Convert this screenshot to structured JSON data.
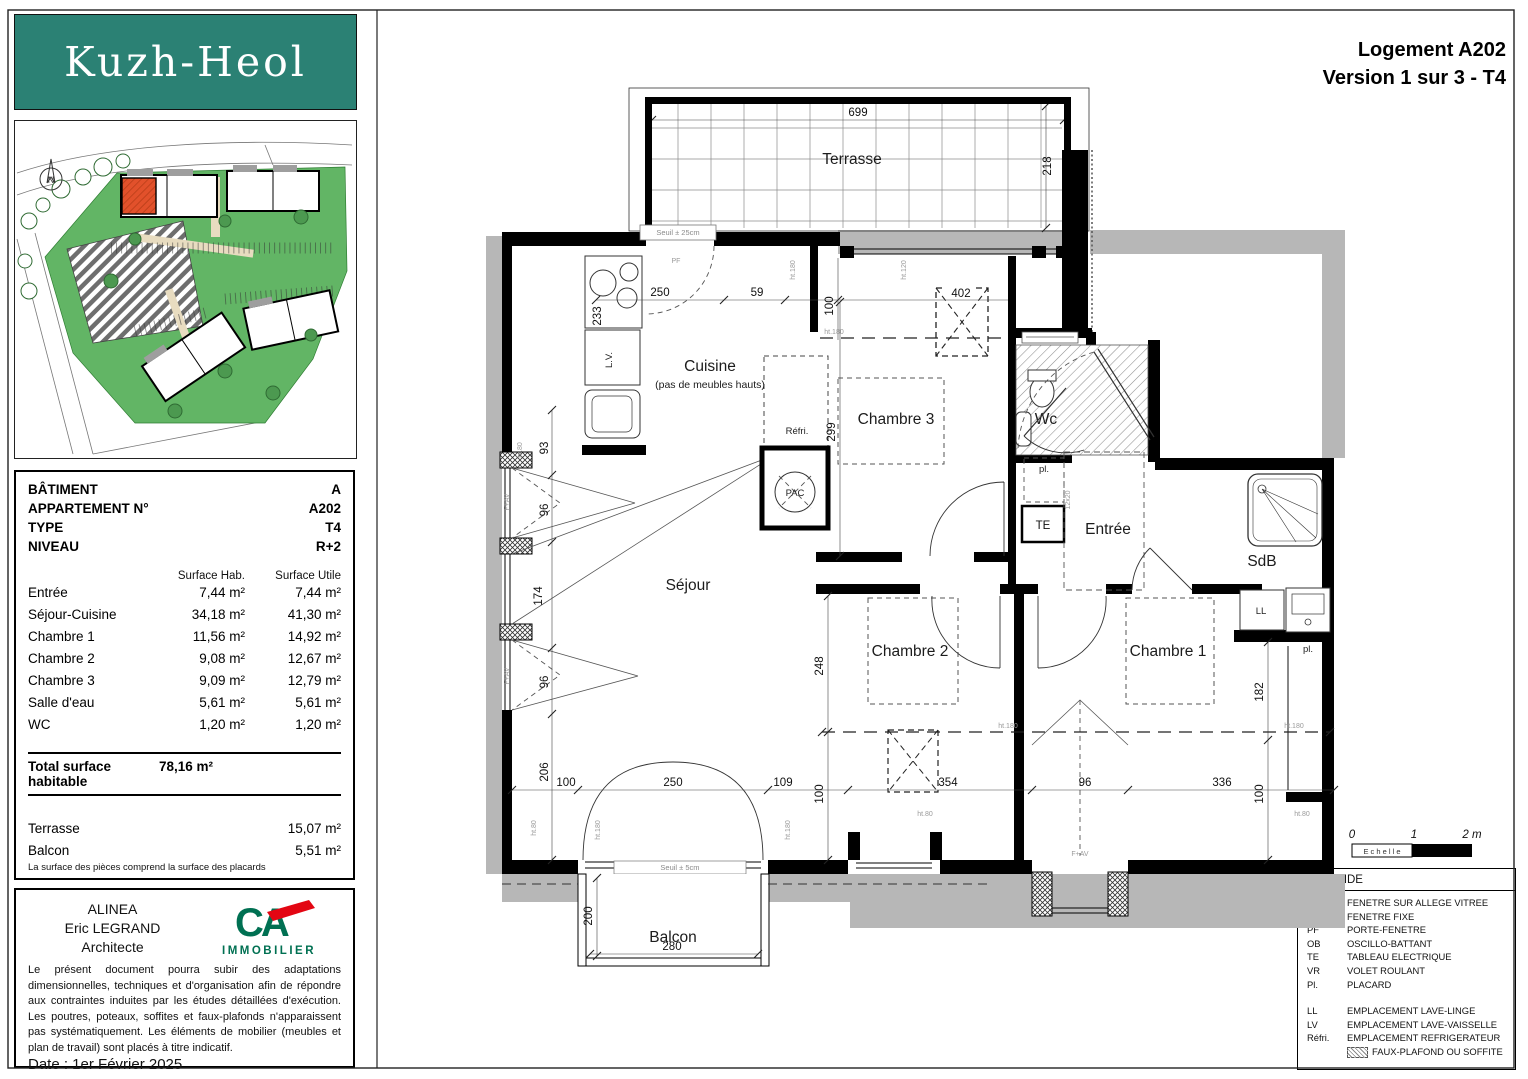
{
  "header": {
    "title_line1": "Logement A202",
    "title_line2": "Version 1 sur 3 - T4"
  },
  "branding": {
    "logo_text": "Kuzh-Heol",
    "logo_bg": "#2b8174",
    "highlight_color": "#e2512b",
    "site_green": "#62b565"
  },
  "info": {
    "fields": [
      {
        "label": "BÂTIMENT",
        "value": "A"
      },
      {
        "label": "APPARTEMENT N°",
        "value": "A202"
      },
      {
        "label": "TYPE",
        "value": "T4"
      },
      {
        "label": "NIVEAU",
        "value": "R+2"
      }
    ],
    "col_header_hab": "Surface Hab.",
    "col_header_utile": "Surface Utile",
    "rooms": [
      {
        "name": "Entrée",
        "hab": "7,44 m²",
        "utile": "7,44 m²"
      },
      {
        "name": "Séjour-Cuisine",
        "hab": "34,18 m²",
        "utile": "41,30 m²"
      },
      {
        "name": "Chambre 1",
        "hab": "11,56 m²",
        "utile": "14,92 m²"
      },
      {
        "name": "Chambre 2",
        "hab": "9,08 m²",
        "utile": "12,67 m²"
      },
      {
        "name": "Chambre 3",
        "hab": "9,09 m²",
        "utile": "12,79 m²"
      },
      {
        "name": "Salle d'eau",
        "hab": "5,61 m²",
        "utile": "5,61 m²"
      },
      {
        "name": "WC",
        "hab": "1,20 m²",
        "utile": "1,20 m²"
      }
    ],
    "total_label": "Total surface habitable",
    "total_value": "78,16 m²",
    "extras": [
      {
        "name": "Terrasse",
        "utile": "15,07 m²"
      },
      {
        "name": "Balcon",
        "utile": "5,51 m²"
      }
    ],
    "footnote": "La surface des pièces comprend la surface des placards"
  },
  "architect": {
    "firm": "ALINEA",
    "name": "Eric LEGRAND",
    "role": "Architecte",
    "brand_mark": "CA",
    "brand": "IMMOBILIER",
    "disclaimer": "Le présent document pourra subir des adaptations dimensionnelles, techniques et d'organisation afin de répondre aux contraintes induites par les études détaillées d'exécution. Les poutres, poteaux, soffites et faux-plafonds n'apparaissent pas systématiquement. Les éléments de mobilier (meubles et plan de travail) sont placés à titre indicatif.",
    "date": "Date : 1er Février 2025"
  },
  "legend": {
    "title": "LEGENDE",
    "rows": [
      {
        "abbr": "F+AV",
        "label": "FENETRE SUR ALLEGE VITREE"
      },
      {
        "abbr": "FF",
        "label": "FENETRE FIXE"
      },
      {
        "abbr": "PF",
        "label": "PORTE-FENETRE"
      },
      {
        "abbr": "OB",
        "label": "OSCILLO-BATTANT"
      },
      {
        "abbr": "TE",
        "label": "TABLEAU ELECTRIQUE"
      },
      {
        "abbr": "VR",
        "label": "VOLET ROULANT"
      },
      {
        "abbr": "Pl.",
        "label": "PLACARD"
      },
      {
        "abbr": "LL",
        "label": "EMPLACEMENT LAVE-LINGE",
        "gap": true
      },
      {
        "abbr": "LV",
        "label": "EMPLACEMENT LAVE-VAISSELLE"
      },
      {
        "abbr": "Réfri.",
        "label": "EMPLACEMENT REFRIGERATEUR"
      },
      {
        "abbr": "",
        "label": "FAUX-PLAFOND OU SOFFITE",
        "swatch": true
      }
    ]
  },
  "plan": {
    "rooms": {
      "terrasse": "Terrasse",
      "cuisine": "Cuisine",
      "cuisine_note": "(pas de meubles hauts)",
      "sejour": "Séjour",
      "chambre1": "Chambre 1",
      "chambre2": "Chambre 2",
      "chambre3": "Chambre 3",
      "wc": "Wc",
      "sdb": "SdB",
      "entree": "Entrée",
      "balcon": "Balcon"
    },
    "labels": {
      "seuil25": "Seuil ± 25cm",
      "seuil5": "Seuil ± 5cm",
      "refri": "Réfri.",
      "pac": "PAC",
      "te": "TE",
      "pl": "pl.",
      "ll": "LL",
      "lv": "L.V.",
      "fav": "F+AV",
      "pf": "PF",
      "ht180": "ht.180",
      "ht80": "ht.80",
      "ht120": "ht.120",
      "d1220": "12x20"
    },
    "dims": {
      "d699": "699",
      "d218": "218",
      "d250": "250",
      "d59": "59",
      "d100": "100",
      "d402": "402",
      "d233": "233",
      "d299": "299",
      "d93": "93",
      "d96": "96",
      "d174": "174",
      "d206": "206",
      "d109": "109",
      "d248": "248",
      "d354": "354",
      "d336": "336",
      "d182": "182",
      "d200": "200",
      "d280": "280"
    },
    "scale": {
      "label": "E c h e l l e",
      "t0": "0",
      "t1": "1",
      "t2": "2 m"
    }
  }
}
